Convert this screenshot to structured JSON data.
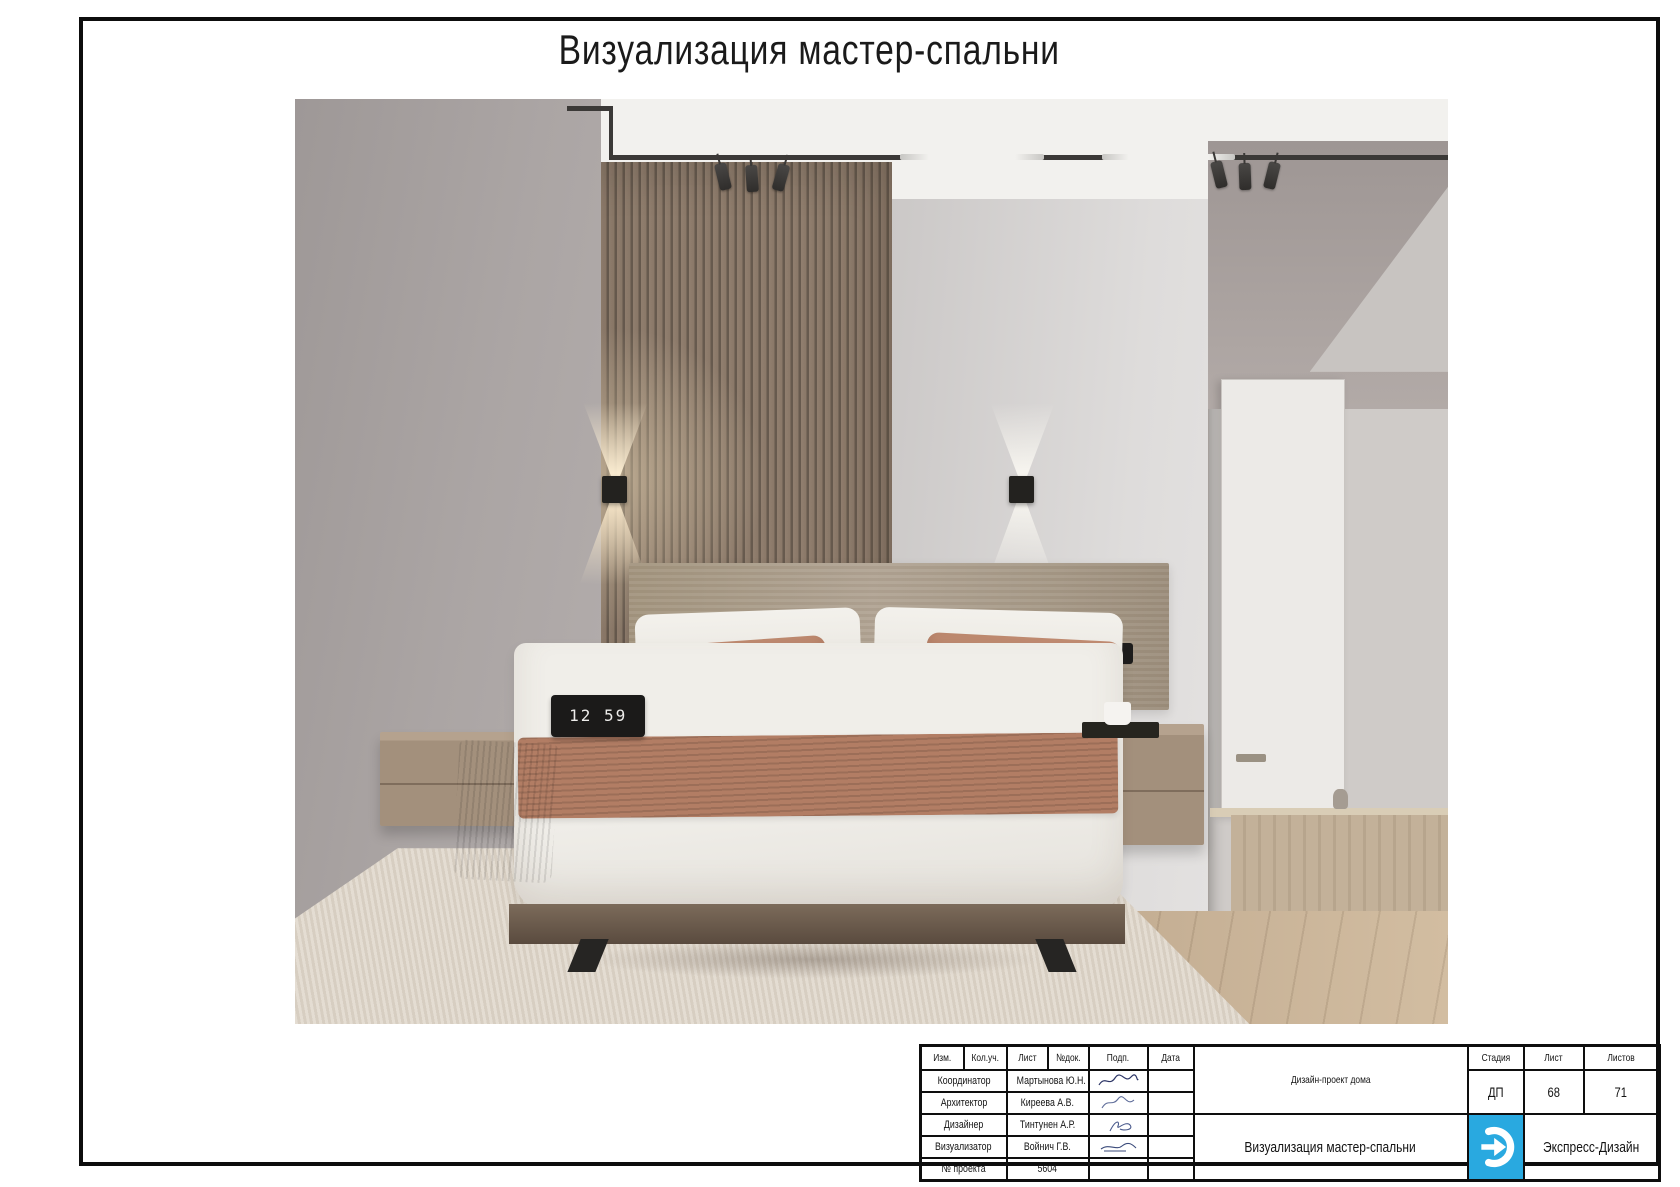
{
  "page": {
    "title": "Визуализация мастер-спальни"
  },
  "stamp": {
    "header_cols": [
      "Изм.",
      "Кол.уч.",
      "Лист",
      "№док.",
      "Подп.",
      "Дата"
    ],
    "rows": [
      {
        "role": "Координатор",
        "name": "Мартынова Ю.Н."
      },
      {
        "role": "Архитектор",
        "name": "Киреева А.В."
      },
      {
        "role": "Дизайнер",
        "name": "Тинтунен А.Р."
      },
      {
        "role": "Визуализатор",
        "name": "Войнич Г.В."
      },
      {
        "role": "№ проекта",
        "name": "5604"
      }
    ],
    "project_title": "Дизайн-проект дома",
    "sheet_title": "Визуализация мастер-спальни",
    "stage_label": "Стадия",
    "sheet_label": "Лист",
    "sheets_label": "Листов",
    "stage_value": "ДП",
    "sheet_value": "68",
    "sheets_value": "71",
    "company": "Экспресс-Дизайн",
    "logo_color": "#29a9e0"
  },
  "render": {
    "clock_time": "12 59",
    "palette": {
      "left_wall": "#a8a2a1",
      "slat_panel": "#8a7868",
      "right_wall": "#d6d4d3",
      "ceiling": "#f2f1ee",
      "rug": "#dcd3c6",
      "wood_floor": "#ccb69c",
      "terracotta_textile": "#b27d64",
      "duvet": "#efede9",
      "headboard": "#a79a88"
    }
  }
}
